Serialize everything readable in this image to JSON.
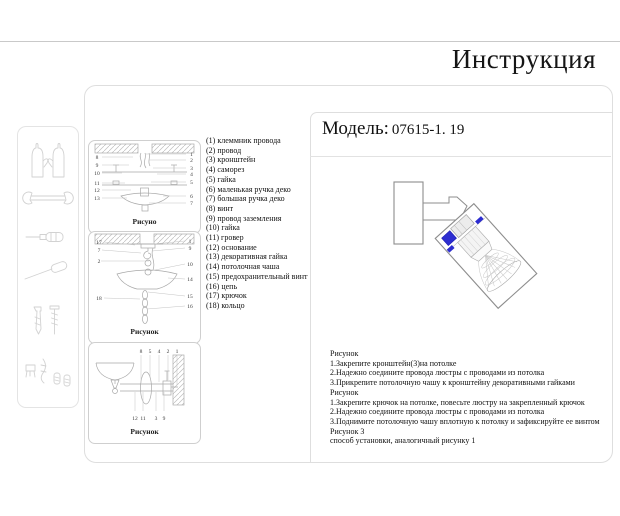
{
  "page": {
    "title": "Инструкция"
  },
  "model": {
    "label": "Модель:",
    "value": "07615-1. 19"
  },
  "tools": {
    "icons": [
      "gloves",
      "wrench",
      "screwdriver",
      "long-screwdriver",
      "dowel-and-screw",
      "small-fasteners"
    ]
  },
  "parts": [
    "(1) клеммник провода",
    "(2) провод",
    "(3) кронштейн",
    "(4) саморез",
    "(5) гайка",
    "(6) маленькая ручка деко",
    "(7) большая ручка деко",
    "(8) винт",
    "(9) провод заземления",
    "(10) гайка",
    "(11) гровер",
    "(12) основание",
    "(13) декоративная гайка",
    "(14) потолочная чаша",
    "(15) предохранительный винт",
    "(16) цепь",
    "(17) крючок",
    "(18) кольцо"
  ],
  "diagrams": [
    {
      "label": "Рисуно",
      "left": [
        "8",
        "9",
        "10",
        "11",
        "12",
        "13"
      ],
      "right": [
        "1",
        "2",
        "3",
        "4",
        "5",
        "6",
        "7"
      ]
    },
    {
      "label": "Рисунок",
      "left": [
        "17",
        "7",
        "2",
        "18"
      ],
      "right": [
        "1",
        "9",
        "10",
        "14",
        "15",
        "16"
      ]
    },
    {
      "label": "Рисунок",
      "top": [
        "8",
        "5",
        "4",
        "2",
        "1"
      ],
      "bottom": [
        "12",
        "11",
        "3",
        "9"
      ]
    }
  ],
  "instructions": [
    "Рисунок",
    "1.Закрепите кронштейн(3)на потолке",
    "2.Надежно соедините провода люстры с проводами из потолка",
    "3.Прикрепите потолочную чашу к кронштейну декоративными гайками",
    "Рисунок",
    "1.Закрепите крючок на потолке, повесьте люстру на закрепленный крючок",
    "2.Надежно соедините провода люстры с проводами из потолка",
    "3.Поднимите потолочную чашу вплотную к потолку и зафиксируйте ее винтом",
    "Рисунок 3",
    "способ установки, аналогичный рисунку 1"
  ],
  "colors": {
    "accent_blue": "#2d2dd0",
    "accent_blue_dark": "#1e1eb0",
    "line_gray": "#a8a8a8",
    "border_gray": "#dedede",
    "text": "#1a1a1a"
  }
}
